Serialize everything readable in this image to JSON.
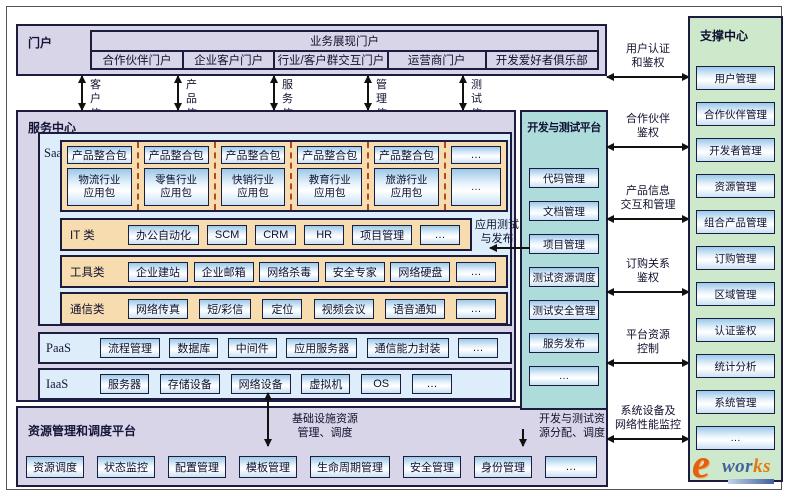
{
  "colors": {
    "lavender": "#d9d5e8",
    "light_blue": "#ddeefa",
    "orange": "#f6dcae",
    "teal": "#addcdb",
    "green": "#cde8ca",
    "box_border": "#1c1c3e"
  },
  "portal": {
    "label": "门户",
    "header": "业务展现门户",
    "items": [
      "合作伙伴门户",
      "企业客户门户",
      "行业/客户群交互门户",
      "运营商门户",
      "开发爱好者俱乐部"
    ]
  },
  "exchange_labels": [
    "客户信息\n交互",
    "产品信息\n交互",
    "服务信息\n交互",
    "管理信息\n交互",
    "测试信息\n交互"
  ],
  "service_center": {
    "label": "服务中心",
    "saas": {
      "label": "SaaS",
      "package_columns": [
        {
          "top": "产品整合包",
          "bottom": "物流行业\n应用包"
        },
        {
          "top": "产品整合包",
          "bottom": "零售行业\n应用包"
        },
        {
          "top": "产品整合包",
          "bottom": "快销行业\n应用包"
        },
        {
          "top": "产品整合包",
          "bottom": "教育行业\n应用包"
        },
        {
          "top": "产品整合包",
          "bottom": "旅游行业\n应用包"
        },
        {
          "top": "…",
          "bottom": "…"
        }
      ],
      "it_category": {
        "label": "IT 类",
        "items": [
          "办公自动化",
          "SCM",
          "CRM",
          "HR",
          "项目管理",
          "…"
        ]
      },
      "tools_category": {
        "label": "工具类",
        "items": [
          "企业建站",
          "企业邮箱",
          "网络杀毒",
          "安全专家",
          "网络硬盘",
          "…"
        ]
      },
      "comm_category": {
        "label": "通信类",
        "items": [
          "网络传真",
          "短/彩信",
          "定位",
          "视频会议",
          "语音通知",
          "…"
        ]
      }
    },
    "paas": {
      "label": "PaaS",
      "items": [
        "流程管理",
        "数据库",
        "中间件",
        "应用服务器",
        "通信能力封装",
        "…"
      ]
    },
    "iaas": {
      "label": "IaaS",
      "items": [
        "服务器",
        "存储设备",
        "网络设备",
        "虚拟机",
        "OS",
        "…"
      ]
    },
    "app_test_label": "应用测试\n与发布"
  },
  "devtest": {
    "label": "开发与测试平台",
    "items": [
      "代码管理",
      "文档管理",
      "项目管理",
      "测试资源调度",
      "测试安全管理",
      "服务发布",
      "…"
    ]
  },
  "resource_platform": {
    "label": "资源管理和调度平台",
    "infra_label": "基础设施资源\n管理、调度",
    "devtest_alloc_label": "开发与测试资\n源分配、调度",
    "items": [
      "资源调度",
      "状态监控",
      "配置管理",
      "模板管理",
      "生命周期管理",
      "安全管理",
      "身份管理",
      "…"
    ]
  },
  "connections": [
    {
      "label": "用户认证\n和鉴权"
    },
    {
      "label": "合作伙伴\n鉴权"
    },
    {
      "label": "产品信息\n交互和管理"
    },
    {
      "label": "订购关系\n鉴权"
    },
    {
      "label": "平台资源\n控制"
    },
    {
      "label": "系统设备及\n网络性能监控"
    }
  ],
  "support": {
    "label": "支撑中心",
    "items": [
      "用户管理",
      "合作伙伴管理",
      "开发者管理",
      "资源管理",
      "组合产品管理",
      "订购管理",
      "区域管理",
      "认证鉴权",
      "统计分析",
      "系统管理",
      "…"
    ]
  },
  "logo": {
    "e": "e",
    "wor": "wor",
    "ks": "ks"
  }
}
